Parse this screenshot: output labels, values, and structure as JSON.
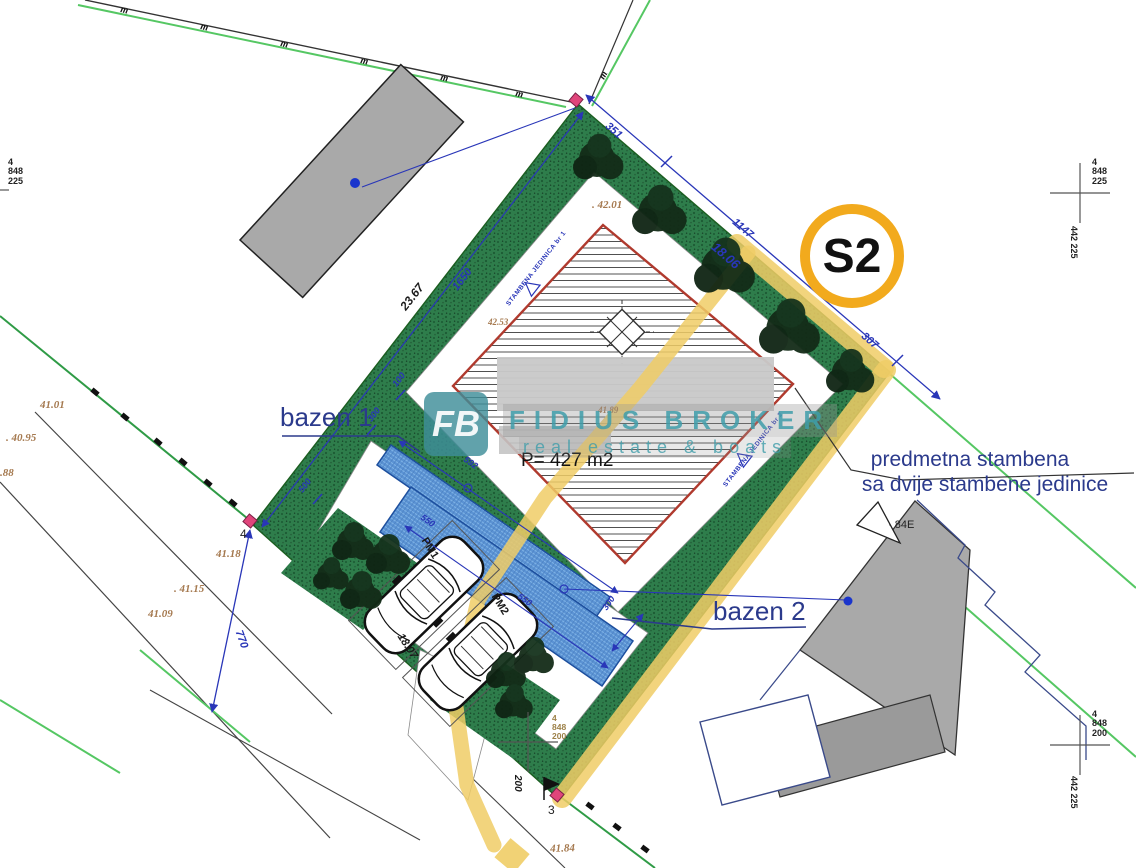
{
  "badge": {
    "label": "S2"
  },
  "watermark": {
    "logo": "FB",
    "brand": "FIDIUS BROKER",
    "tagline": "real estate & boats"
  },
  "callouts": {
    "note_line1": "predmetna stambena",
    "note_line2": "sa dvije stambene jedinice",
    "pool1": "bazen 1",
    "pool2": "bazen 2",
    "house_area": "P= 427 m2",
    "parking_spot1": "PM1",
    "parking_spot2": "PM2",
    "unit1": "STAMBENA JEDINICA br 1",
    "unit2": "STAMBENA JEDINICA br 2",
    "neighbor_house": "· 84E",
    "boundary_point3": "3",
    "boundary_point4": "4"
  },
  "dimensions": {
    "seg_top": "351",
    "ne_total_cm": "1147",
    "ne_total_m": "18.06",
    "seg_right": "307",
    "nw_total_m": "23.67",
    "nw_inner": "1650",
    "nw_seg100": "100",
    "nw_seg300": "300",
    "nw_seg500": "500",
    "pool_len592": "592",
    "pool_550a": "550",
    "pool_550b": "550",
    "pool_width300": "300",
    "sw_seg770": "770",
    "drive_len": "18.07",
    "bottom_200": "200"
  },
  "elevations": {
    "e1": ". 42.01",
    "e2": "41.89",
    "e3": "42.53",
    "e4": "41.01",
    "e5": ". 40.95",
    "e6": ".88",
    "e7": "41.18",
    "e8": ". 41.15",
    "e9": "41.09",
    "e10": "41.84"
  },
  "grid": {
    "left": "4\n848\n225",
    "top_right": "4\n848\n225",
    "bottom_right": "4\n848\n200",
    "bottom_center": "4\n848\n200",
    "easting_top": "442 225",
    "easting_bottom": "442 225"
  },
  "symbols": {
    "fence_mark": "m"
  }
}
